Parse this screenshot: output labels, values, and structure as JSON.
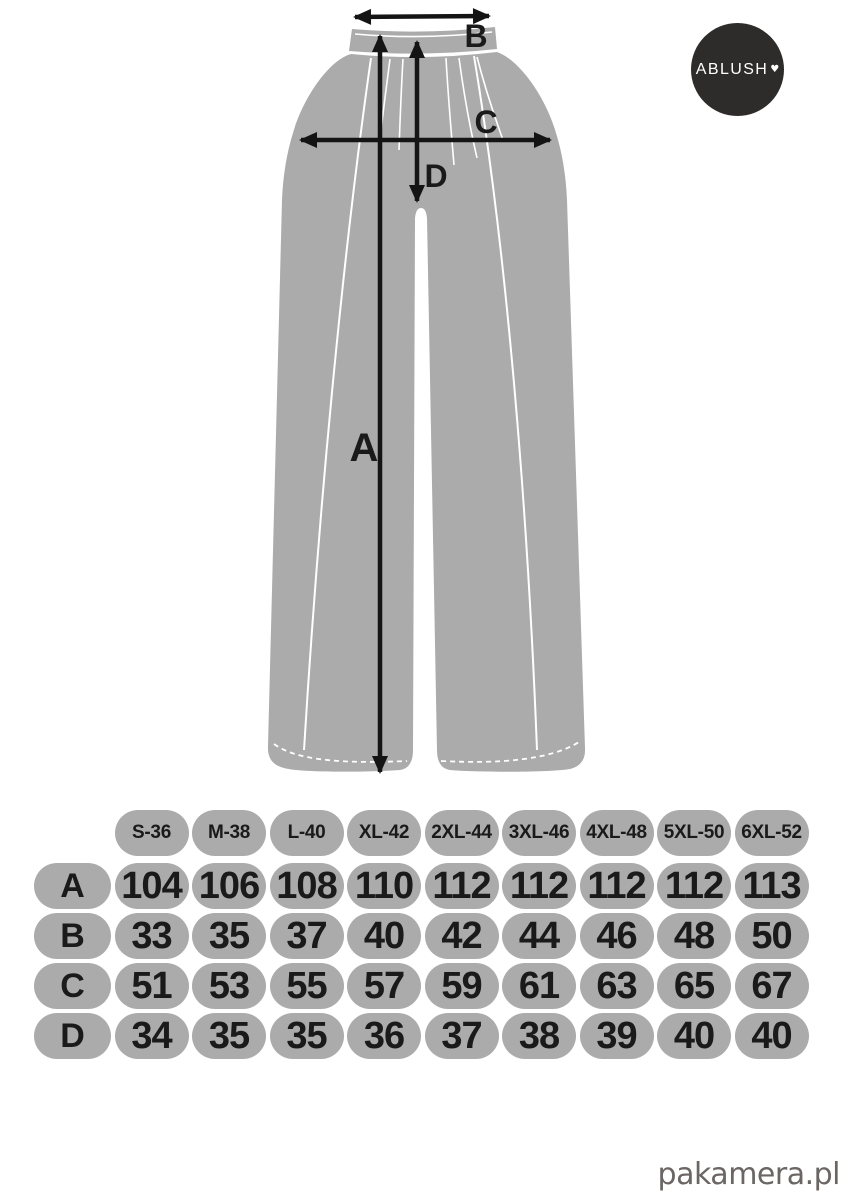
{
  "brand": {
    "logo_text": "ABLUSH",
    "heart": "♥"
  },
  "diagram": {
    "labels": {
      "A": "A",
      "B": "B",
      "C": "C",
      "D": "D"
    }
  },
  "size_table": {
    "sizes": [
      "S-36",
      "M-38",
      "L-40",
      "XL-42",
      "2XL-44",
      "3XL-46",
      "4XL-48",
      "5XL-50",
      "6XL-52"
    ],
    "rows": [
      {
        "label": "A",
        "values": [
          "104",
          "106",
          "108",
          "110",
          "112",
          "112",
          "112",
          "112",
          "113"
        ]
      },
      {
        "label": "B",
        "values": [
          "33",
          "35",
          "37",
          "40",
          "42",
          "44",
          "46",
          "48",
          "50"
        ]
      },
      {
        "label": "C",
        "values": [
          "51",
          "53",
          "55",
          "57",
          "59",
          "61",
          "63",
          "65",
          "67"
        ]
      },
      {
        "label": "D",
        "values": [
          "34",
          "35",
          "35",
          "36",
          "37",
          "38",
          "39",
          "40",
          "40"
        ]
      }
    ]
  },
  "footer": {
    "watermark": "pakamera.pl"
  },
  "colors": {
    "fabric": "#ababab",
    "cell": "#ababab",
    "arrow": "#141414",
    "logo_bg": "#2e2b2b",
    "logo_text": "#ffffff",
    "watermark": "#6b6663",
    "text": "#1a1a1a"
  }
}
